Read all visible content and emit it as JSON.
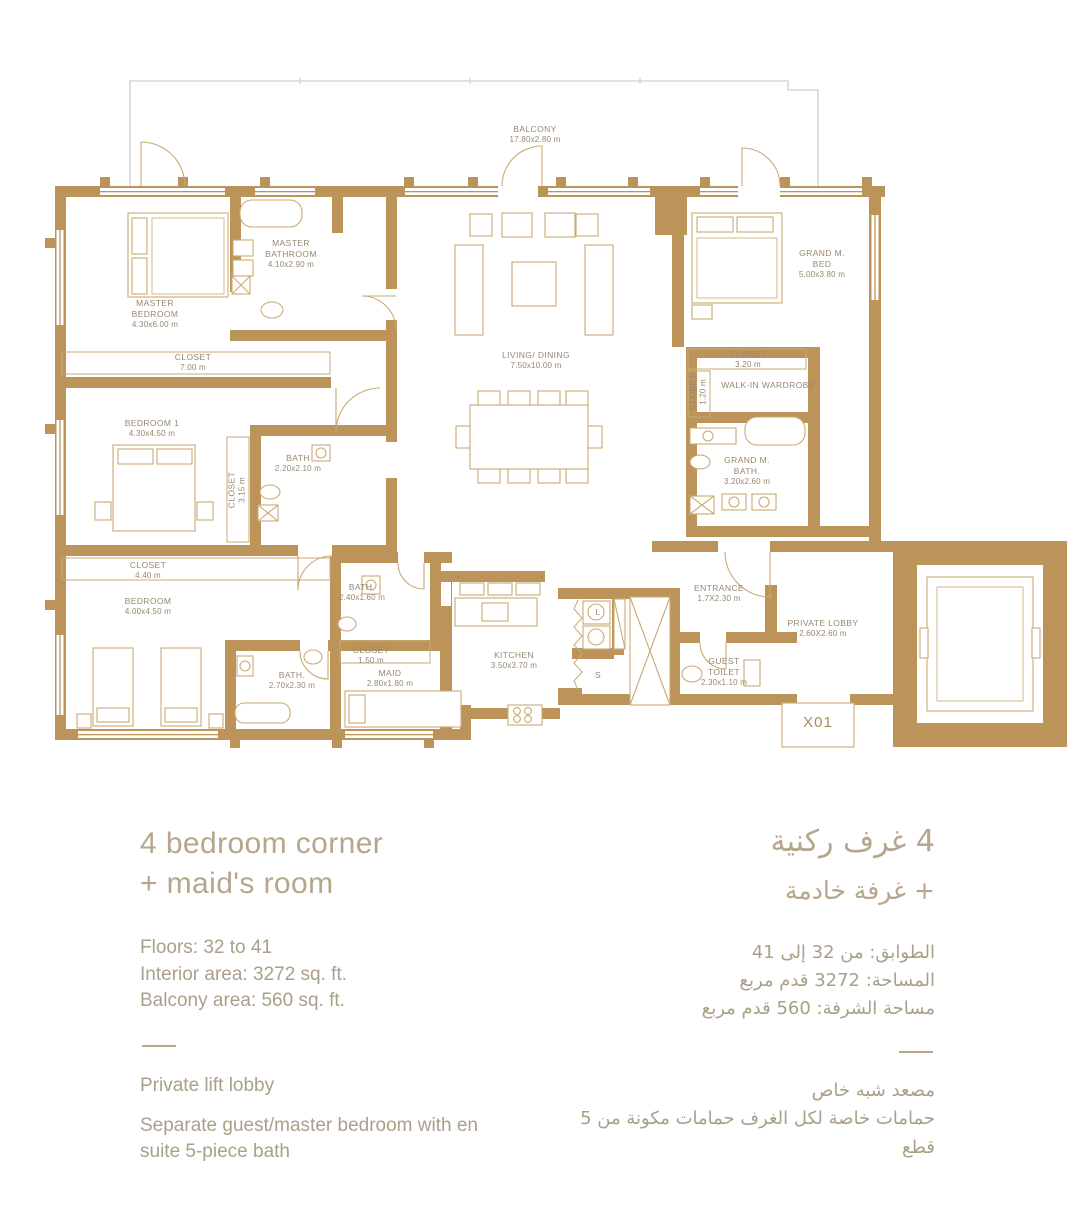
{
  "colors": {
    "wall_gold": "#BC9459",
    "furniture_line": "#C9AA74",
    "balcony_gray": "#D8D7D2",
    "label_text": "#97876E",
    "heading_text": "#B5A68C",
    "body_text": "#AA9F89"
  },
  "plan": {
    "x01": "X01",
    "labels": [
      {
        "id": "balcony",
        "lines": [
          "BALCONY"
        ],
        "dims": "17.80x2.80 m",
        "x": 535,
        "y": 124
      },
      {
        "id": "master-bathroom",
        "lines": [
          "MASTER",
          "BATHROOM"
        ],
        "dims": "4.10x2.90 m",
        "x": 291,
        "y": 238
      },
      {
        "id": "master-bedroom",
        "lines": [
          "MASTER",
          "BEDROOM"
        ],
        "dims": "4.30x6.00 m",
        "x": 155,
        "y": 298
      },
      {
        "id": "grand-m-bed",
        "lines": [
          "GRAND M.",
          "BED"
        ],
        "dims": "5.00x3.80 m",
        "x": 822,
        "y": 248
      },
      {
        "id": "closet-master",
        "lines": [
          "CLOSET"
        ],
        "dims": "7.00 m",
        "x": 193,
        "y": 352
      },
      {
        "id": "living-dining",
        "lines": [
          "LIVING/ DINING"
        ],
        "dims": "7.50x10.00 m",
        "x": 536,
        "y": 350
      },
      {
        "id": "closet-grand",
        "lines": [
          "CLOSET"
        ],
        "dims": "3.20 m",
        "x": 748,
        "y": 349
      },
      {
        "id": "closet-grand-vertical",
        "lines": [
          "CLOSET"
        ],
        "dims": "1.20 m",
        "x": 698,
        "y": 392,
        "rot": 1
      },
      {
        "id": "walk-in-wardrobe",
        "lines": [
          "WALK-IN WARDROBE"
        ],
        "dims": "",
        "x": 768,
        "y": 380
      },
      {
        "id": "bedroom-1",
        "lines": [
          "BEDROOM 1"
        ],
        "dims": "4.30x4.50 m",
        "x": 152,
        "y": 418
      },
      {
        "id": "bath-1",
        "lines": [
          "BATH"
        ],
        "dims": "2.20x2.10 m",
        "x": 298,
        "y": 453
      },
      {
        "id": "closet-bed1-vertical",
        "lines": [
          "CLOSET"
        ],
        "dims": "3.15 m",
        "x": 237,
        "y": 490,
        "rot": 1
      },
      {
        "id": "grand-m-bath",
        "lines": [
          "GRAND M.",
          "BATH."
        ],
        "dims": "3.20x2.60 m",
        "x": 747,
        "y": 455
      },
      {
        "id": "closet-bedroom",
        "lines": [
          "CLOSET"
        ],
        "dims": "4.40 m",
        "x": 148,
        "y": 560
      },
      {
        "id": "bedroom",
        "lines": [
          "BEDROOM"
        ],
        "dims": "4.00x4.50 m",
        "x": 148,
        "y": 596
      },
      {
        "id": "bath-2",
        "lines": [
          "BATH."
        ],
        "dims": "2.40x1.60 m",
        "x": 362,
        "y": 582
      },
      {
        "id": "entrance",
        "lines": [
          "ENTRANCE"
        ],
        "dims": "1.7X2.30 m",
        "x": 719,
        "y": 583
      },
      {
        "id": "private-lobby",
        "lines": [
          "PRIVATE LOBBY"
        ],
        "dims": "2.60X2.60 m",
        "x": 823,
        "y": 618
      },
      {
        "id": "closet-maid",
        "lines": [
          "CLOSET"
        ],
        "dims": "1.50 m",
        "x": 371,
        "y": 645
      },
      {
        "id": "maid",
        "lines": [
          "MAID"
        ],
        "dims": "2.80x1.80 m",
        "x": 390,
        "y": 668
      },
      {
        "id": "kitchen",
        "lines": [
          "KITCHEN"
        ],
        "dims": "3.50x3.70 m",
        "x": 514,
        "y": 650
      },
      {
        "id": "bath-3",
        "lines": [
          "BATH."
        ],
        "dims": "2.70x2.30 m",
        "x": 292,
        "y": 670
      },
      {
        "id": "guest-toilet",
        "lines": [
          "GUEST",
          "TOILET"
        ],
        "dims": "2.30x1.10 m",
        "x": 724,
        "y": 656
      },
      {
        "id": "laundry",
        "lines": [
          "L"
        ],
        "dims": "",
        "x": 598,
        "y": 607
      },
      {
        "id": "stairs",
        "lines": [
          "S"
        ],
        "dims": "",
        "x": 598,
        "y": 670
      }
    ]
  },
  "info_en": {
    "title_line1": "4 bedroom corner",
    "title_line2": "+ maid's room",
    "floors": "Floors: 32 to 41",
    "interior": "Interior area: 3272 sq. ft.",
    "balcony": "Balcony area: 560 sq. ft.",
    "feature1": "Private lift lobby",
    "feature2": "Separate guest/master bedroom with en suite 5-piece bath"
  },
  "info_ar": {
    "title_line1": "4 غرف ركنية",
    "title_line2": "+ غرفة خادمة",
    "floors": "الطوابق: من 32 إلى 41",
    "interior": "المساحة: 3272 قدم مربع",
    "balcony": "مساحة الشرفة: 560 قدم مربع",
    "feature1": "مصعد شبه خاص",
    "feature2": "حمامات خاصة لكل الغرف حمامات مكونة من 5 قطع"
  }
}
